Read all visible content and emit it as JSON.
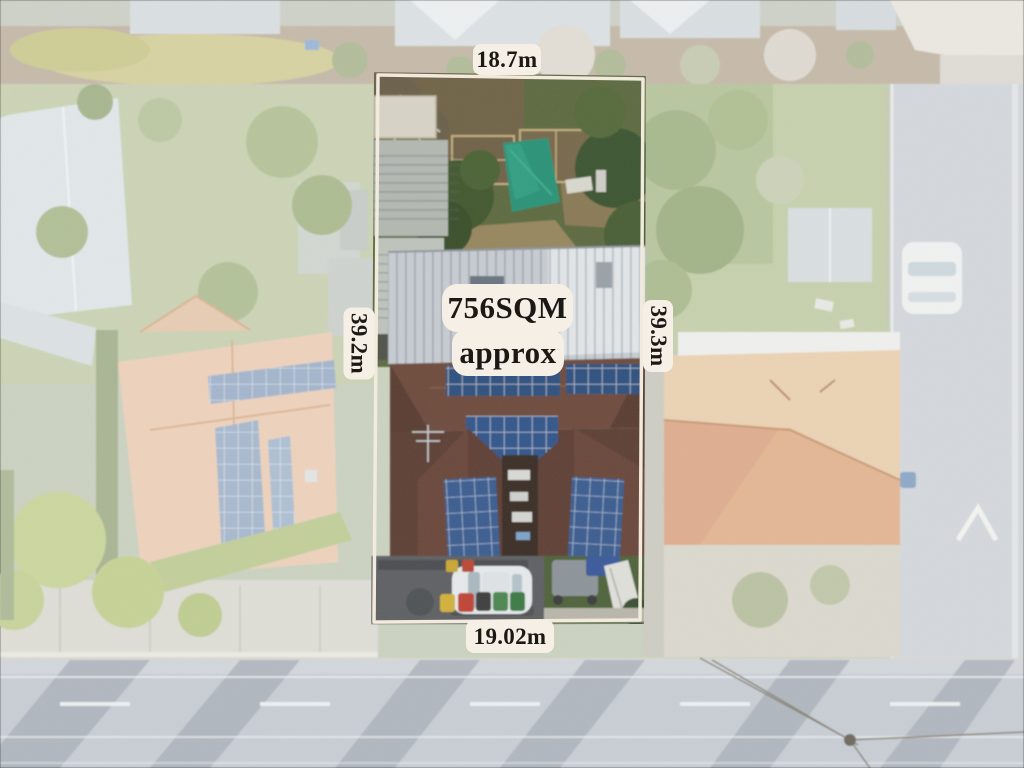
{
  "annotations": {
    "top_width_label": "18.7m",
    "left_depth_label": "39.2m",
    "right_depth_label": "39.3m",
    "bottom_width_label": "19.02m",
    "area_label_line1": "756SQM",
    "area_label_line2": "approx"
  },
  "colors": {
    "label_background": "#f5efe5",
    "label_text": "#1c1814",
    "boundary_line": "#f1eadd"
  }
}
